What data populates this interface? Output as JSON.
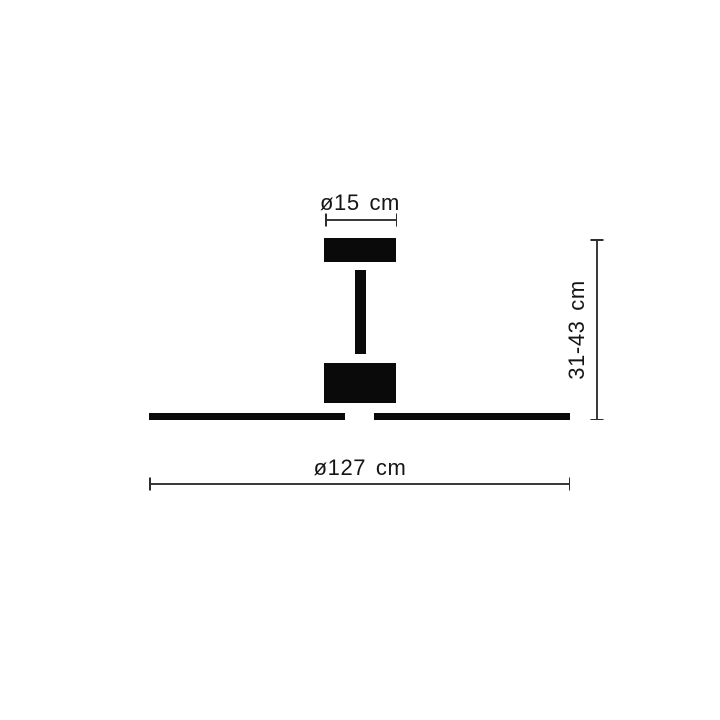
{
  "diagram": {
    "name": "ceiling-fan-dimension-diagram",
    "background": "#ffffff",
    "ink_color": "#0a0a0a",
    "dimension_line_color": "#3c3c3c",
    "labels": {
      "top_diameter": "ø15 cm",
      "height_range": "31-43 cm",
      "overall_diameter": "ø127 cm"
    }
  }
}
